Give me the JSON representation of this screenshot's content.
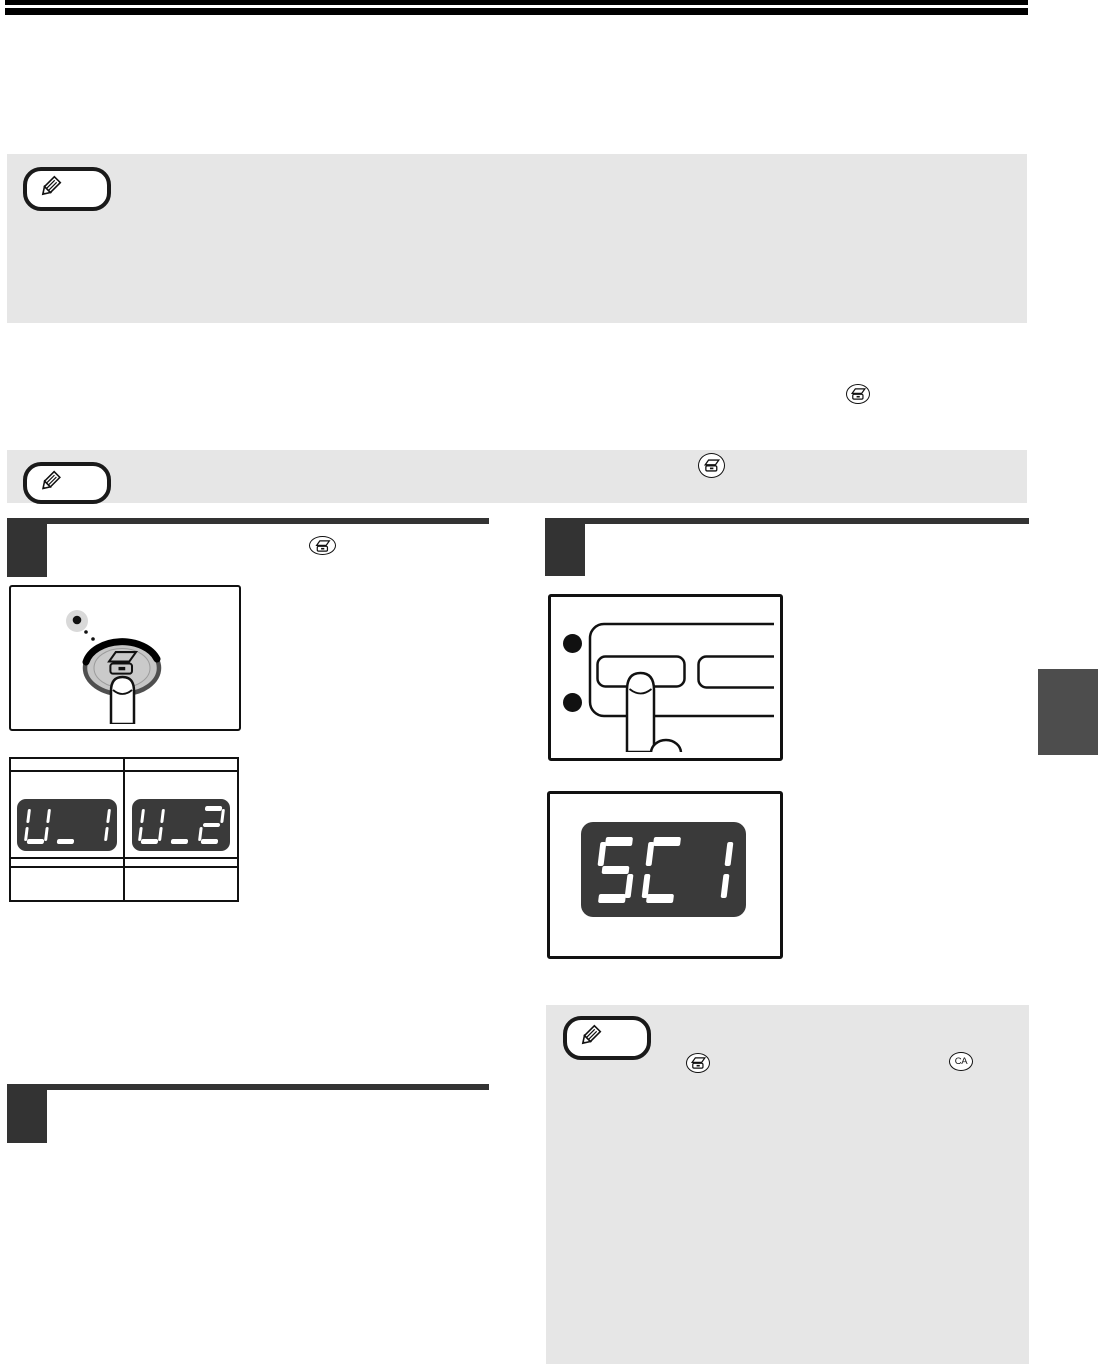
{
  "page": {
    "kind": "copier operation manual page",
    "background": "#ffffff"
  },
  "header": {
    "bar_color": "#000000"
  },
  "note_boxes": {
    "background": "#e6e6e6",
    "icon": "pencil"
  },
  "step_markers": {
    "color": "#333333",
    "count": 3
  },
  "figures": {
    "scan_button": {
      "led_color": "#d9d9d9",
      "face_color": "#c6c6c6",
      "ring_color": "#4f4f4f"
    },
    "user_display": {
      "left_value": "U_1",
      "right_value": "U_2",
      "background": "#3a3a3a",
      "segment_color": "#ffffff"
    },
    "error_display": {
      "value": "SC1",
      "background": "#3a3a3a",
      "segment_color": "#ffffff"
    }
  },
  "icons": {
    "scan_key": "scan-key",
    "clear_all_label": "CA",
    "note": "pencil"
  },
  "side_tab": {
    "color": "#4d4d4d"
  }
}
